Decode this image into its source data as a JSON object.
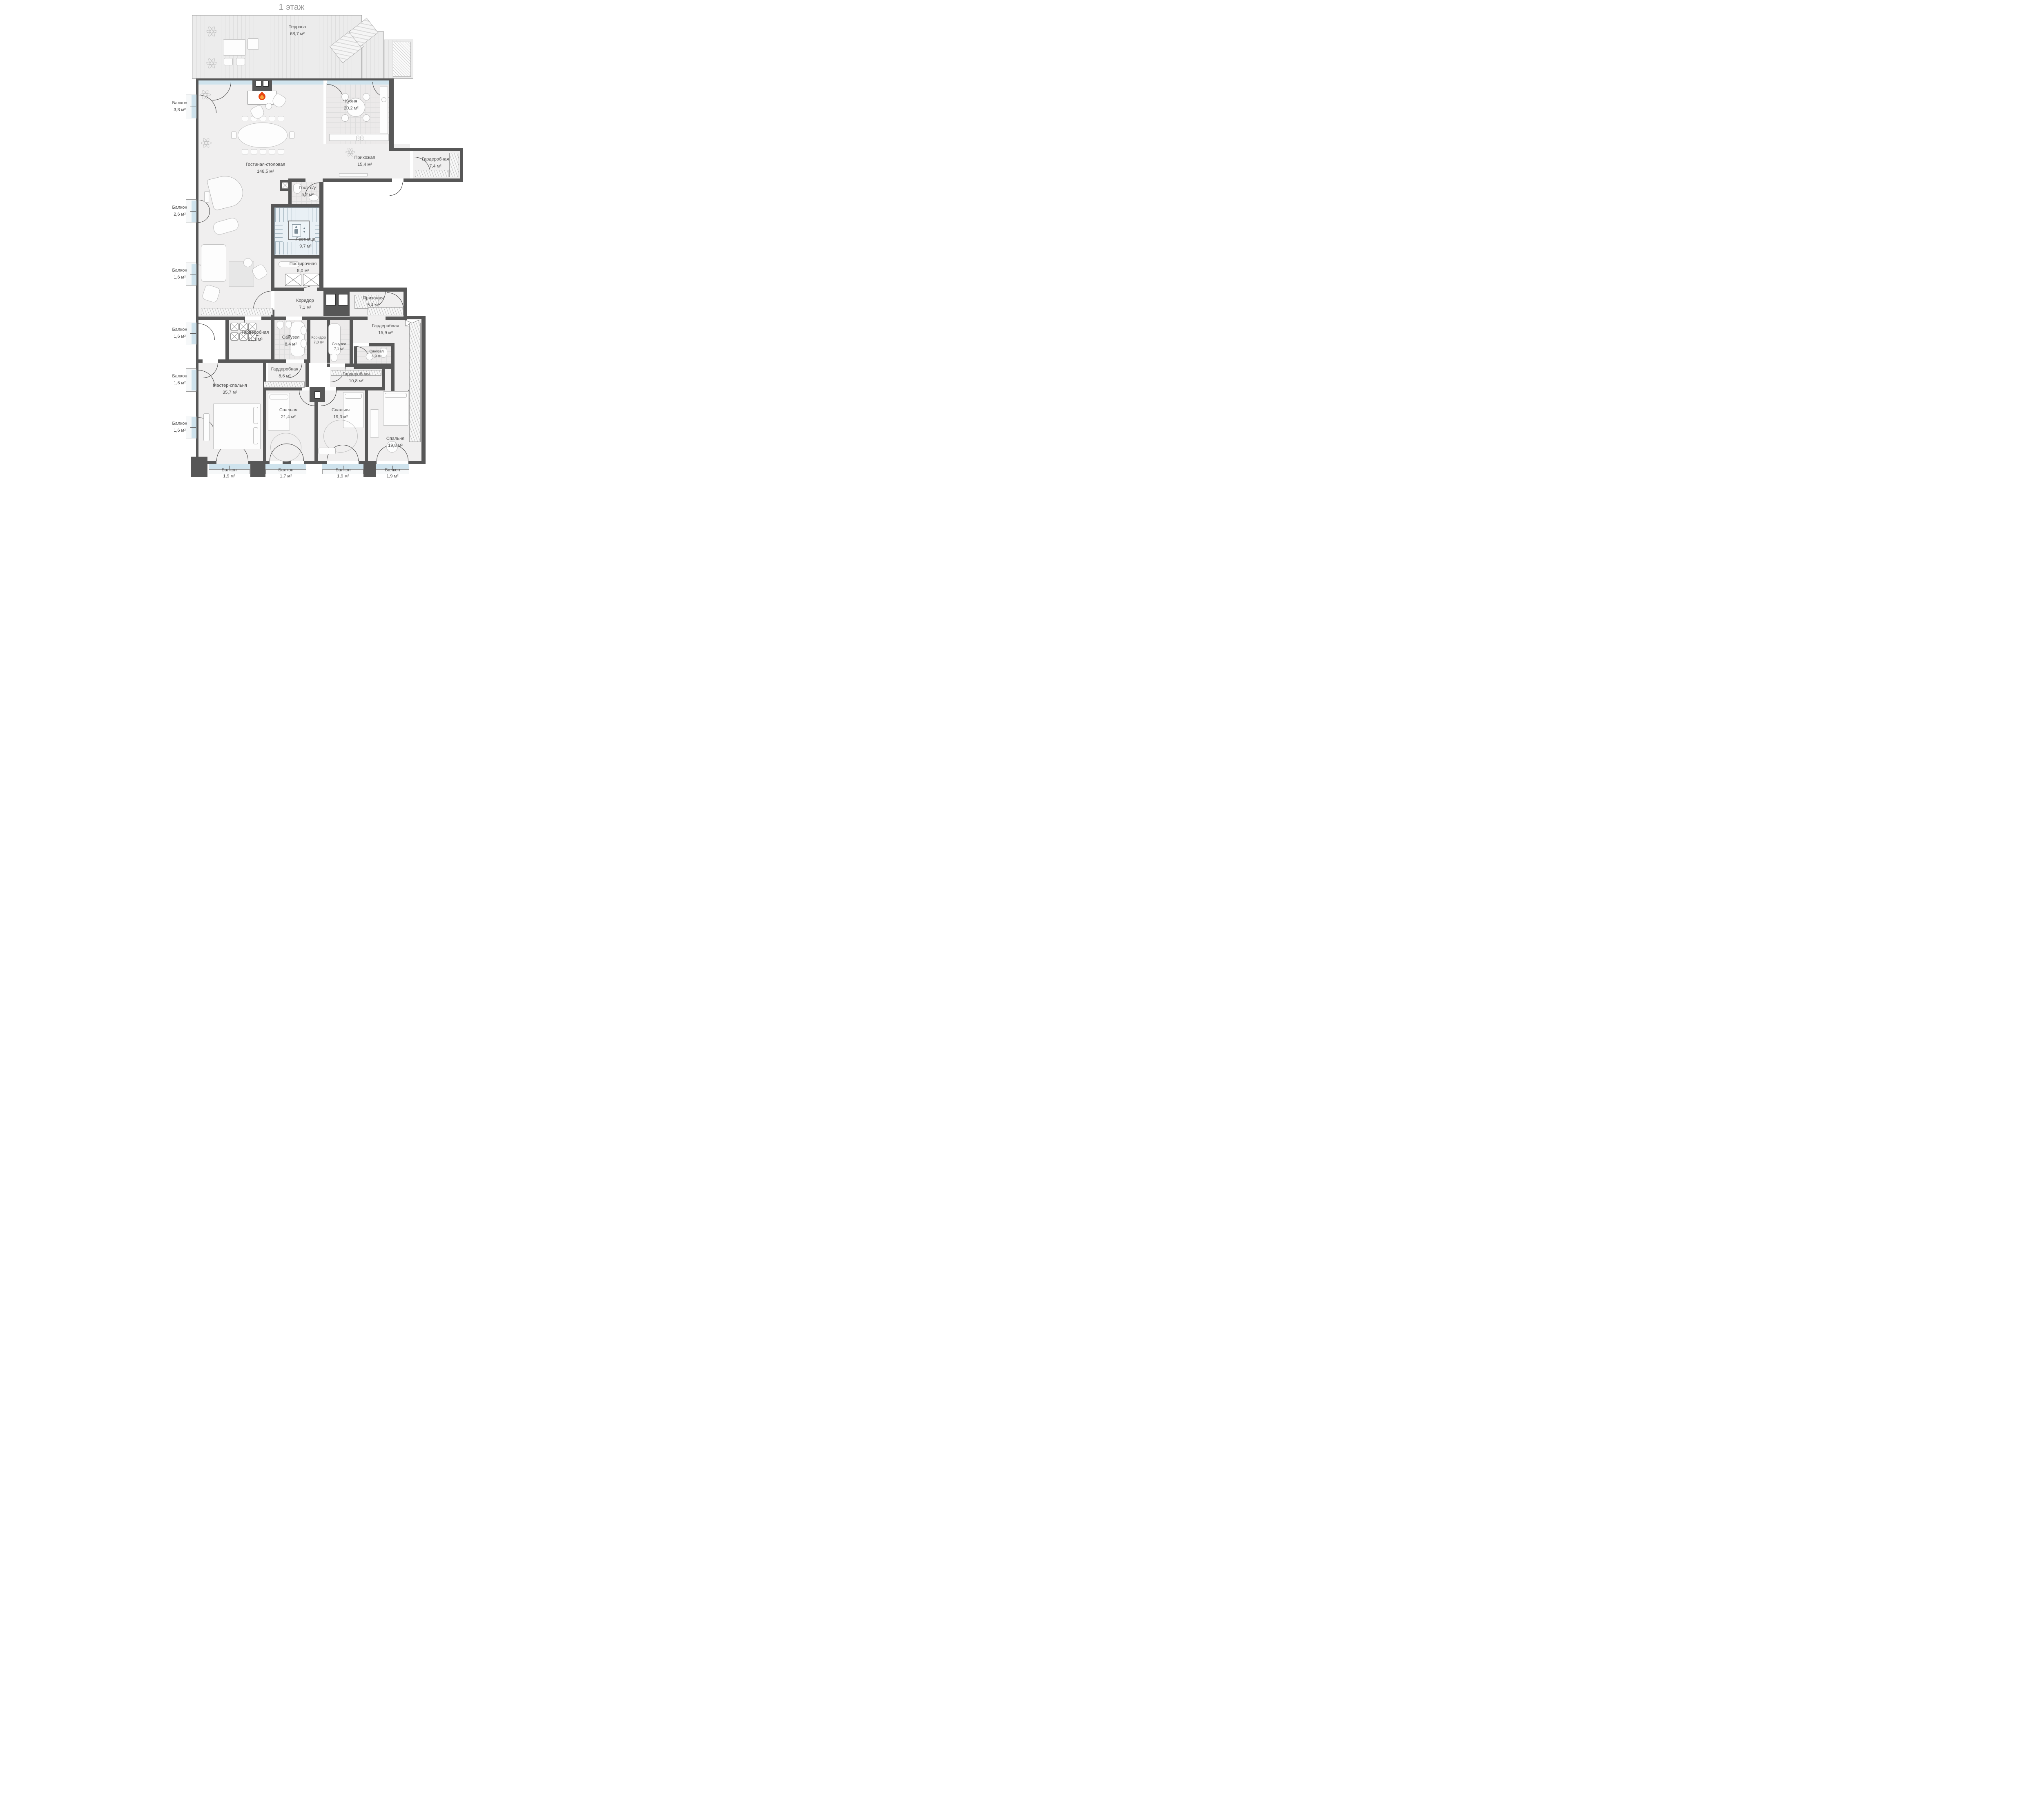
{
  "title": "1 этаж",
  "rooms": [
    {
      "name": "Терраса",
      "area": "68,7 м²"
    },
    {
      "name": "Гостиная-столовая",
      "area": "148,5 м²"
    },
    {
      "name": "Кухня",
      "area": "20,2 м²"
    },
    {
      "name": "Прихожая",
      "area": "15,4 м²"
    },
    {
      "name": "Гардеробная",
      "area": "7,4 м²"
    },
    {
      "name": "Гост. с/у",
      "area": "5,2 м²"
    },
    {
      "name": "Лестница",
      "area": "9,7 м²"
    },
    {
      "name": "Постирочная",
      "area": "8,0 м²"
    },
    {
      "name": "Коридор",
      "area": "7,1 м²"
    },
    {
      "name": "Прихожая",
      "area": "5,4 м²"
    },
    {
      "name": "Гардеробная",
      "area": "21,1 м²"
    },
    {
      "name": "Санузел",
      "area": "8,4 м²"
    },
    {
      "name": "Коридор",
      "area": "7,0 м²"
    },
    {
      "name": "Санузел",
      "area": "7,1 м²"
    },
    {
      "name": "Гардеробная",
      "area": "15,9 м²"
    },
    {
      "name": "Санузел",
      "area": "4,9 м²"
    },
    {
      "name": "Гардеробная",
      "area": "8,6 м²"
    },
    {
      "name": "Гардеробная",
      "area": "10,8 м²"
    },
    {
      "name": "Мастер-спальня",
      "area": "35,7 м²"
    },
    {
      "name": "Спальня",
      "area": "21,4 м²"
    },
    {
      "name": "Спальня",
      "area": "19,3 м²"
    },
    {
      "name": "Спальня",
      "area": "19,8 м²"
    }
  ],
  "balconies_left": [
    {
      "name": "Балкон",
      "area": "3,8 м²"
    },
    {
      "name": "Балкон",
      "area": "2,6 м²"
    },
    {
      "name": "Балкон",
      "area": "1,6 м²"
    },
    {
      "name": "Балкон",
      "area": "1,6 м²"
    },
    {
      "name": "Балкон",
      "area": "1,6 м²"
    },
    {
      "name": "Балкон",
      "area": "1,6 м²"
    }
  ],
  "balconies_bottom": [
    {
      "name": "Балкон",
      "area": "1,9 м²"
    },
    {
      "name": "Балкон",
      "area": "1,7 м²"
    },
    {
      "name": "Балкон",
      "area": "1,9 м²"
    },
    {
      "name": "Балкон",
      "area": "1,9 м²"
    }
  ],
  "icons": {
    "elevator_up": "▲",
    "elevator_down": "▼"
  },
  "colors": {
    "wall": "#575757",
    "room_fill": "#f0efef",
    "glazing": "#cfe3ed",
    "stairs_fill": "#e9f0f5",
    "flame_outer": "#e8440f",
    "flame_inner": "#f9a43c",
    "label": "#4b4b4b"
  }
}
